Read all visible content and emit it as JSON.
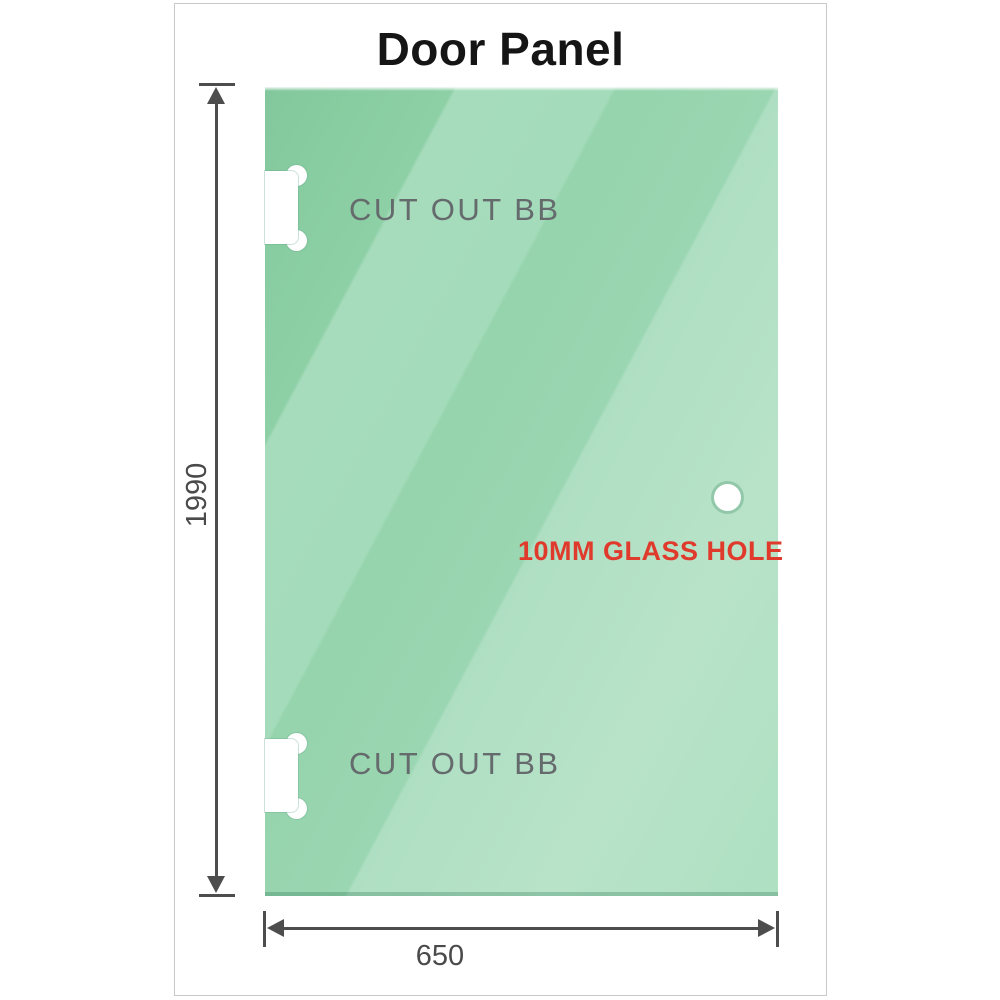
{
  "title": "Door Panel",
  "panel": {
    "cutout_top_label": "CUT OUT BB",
    "cutout_bottom_label": "CUT OUT BB",
    "glass_hole_label": "10MM GLASS HOLE"
  },
  "dimensions": {
    "height_label": "1990",
    "width_label": "650"
  },
  "colors": {
    "glass_base": "#8ed0a6",
    "glass_light_stripe": "#b8e3c9",
    "dimension_gray": "#4d4d4d",
    "cutout_label_gray": "#656a6c",
    "annotation_red": "#e03a2c",
    "frame_border": "#c9c9c9",
    "title_black": "#151515"
  }
}
